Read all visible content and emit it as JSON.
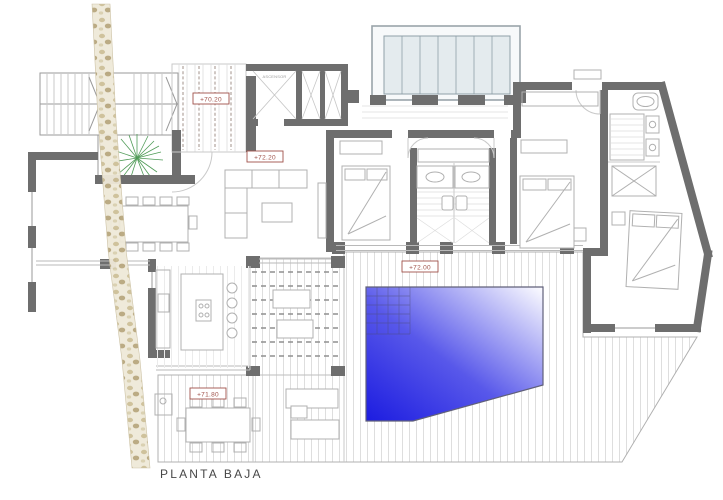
{
  "drawing": {
    "title": "PLANTA BAJA",
    "levels": {
      "ramp": "+70.20",
      "hall": "+72.20",
      "pool_deck": "+72.00",
      "terrace": "+71.80"
    },
    "rooms": {
      "elevator": "ASCENSOR"
    }
  },
  "colors": {
    "wall": "#6e6e6e",
    "label": "#a0524a",
    "glass": "#e4ebee",
    "glass_edge": "#8fa0a8",
    "pool_deep": "#1c1ce0",
    "pool_mid": "#5858ea",
    "pool_light": "#fdfdff",
    "pool_edge": "#60607a",
    "plant": "#4f9b57",
    "stone_a": "#cdbf97",
    "stone_b": "#b8a77e"
  }
}
